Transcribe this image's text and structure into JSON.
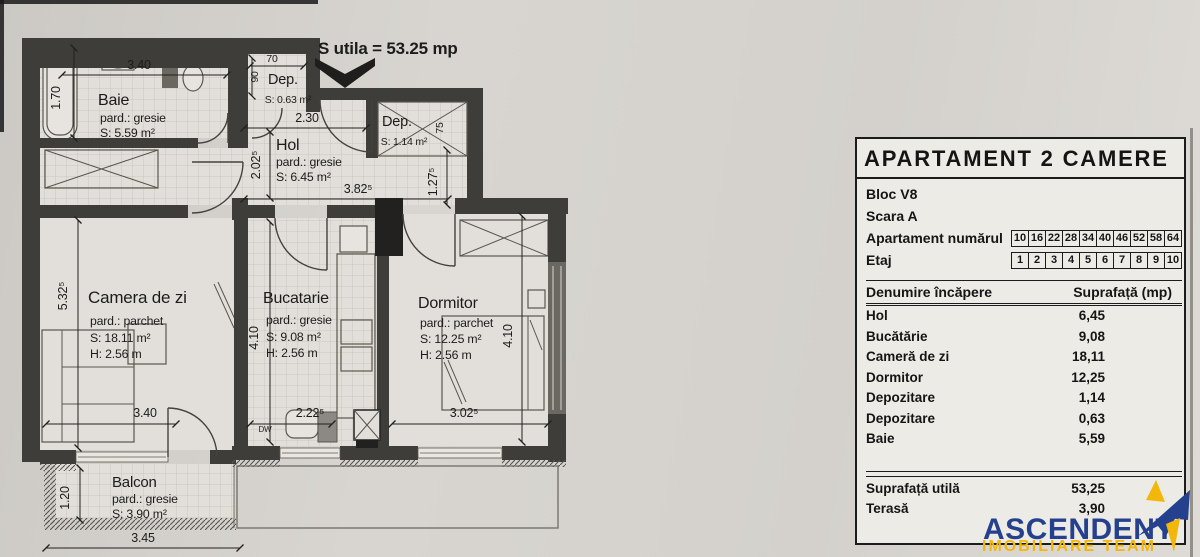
{
  "plan": {
    "utila_note": "S utila = 53.25 mp",
    "rooms": {
      "baie": {
        "name": "Baie",
        "floor": "pard.: gresie",
        "area": "S: 5.59 m²"
      },
      "dep1": {
        "name": "Dep.",
        "area": "S: 0.63 m²"
      },
      "hol": {
        "name": "Hol",
        "floor": "pard.: gresie",
        "area": "S: 6.45 m²"
      },
      "dep2": {
        "name": "Dep.",
        "area": "S: 1.14 m²"
      },
      "camera_de_zi": {
        "name": "Camera de zi",
        "floor": "pard.: parchet",
        "area": "S: 18.11 m²",
        "height": "H: 2.56 m"
      },
      "bucatarie": {
        "name": "Bucatarie",
        "floor": "pard.: gresie",
        "area": "S: 9.08 m²",
        "height": "H: 2.56 m"
      },
      "dormitor": {
        "name": "Dormitor",
        "floor": "pard.: parchet",
        "area": "S: 12.25 m²",
        "height": "H: 2.56 m"
      },
      "balcon": {
        "name": "Balcon",
        "floor": "pard.: gresie",
        "area": "S: 3.90 m²"
      }
    },
    "dims": {
      "baie_w": "3.40",
      "baie_h": "1.70",
      "dep1_w": "70",
      "dep1_h": "90",
      "hol_w": "2.30",
      "hol_h": "2.02⁵",
      "hol_w2": "3.82⁵",
      "dep2_d": "75",
      "dep2_v": "1.27⁵",
      "camera_w": "3.40",
      "camera_h": "5.32⁵",
      "bucatarie_w": "2.22⁵",
      "bucatarie_h": "4.10",
      "dormitor_w": "3.02⁵",
      "dormitor_h": "4.10",
      "balcon_w": "3.45",
      "balcon_h": "1.20",
      "dishwasher": "DW"
    }
  },
  "panel": {
    "title": "APARTAMENT 2 CAMERE",
    "bloc": "Bloc V8",
    "scara": "Scara A",
    "apartament_label": "Apartament numărul",
    "apartament_numbers": [
      "10",
      "16",
      "22",
      "28",
      "34",
      "40",
      "46",
      "52",
      "58",
      "64"
    ],
    "etaj_label": "Etaj",
    "etaj_numbers": [
      "1",
      "2",
      "3",
      "4",
      "5",
      "6",
      "7",
      "8",
      "9",
      "10"
    ],
    "table": {
      "col_room": "Denumire încăpere",
      "col_area": "Suprafață (mp)",
      "rows": [
        {
          "room": "Hol",
          "area": "6,45"
        },
        {
          "room": "Bucătărie",
          "area": "9,08"
        },
        {
          "room": "Cameră de zi",
          "area": "18,11"
        },
        {
          "room": "Dormitor",
          "area": "12,25"
        },
        {
          "room": "Depozitare",
          "area": "1,14"
        },
        {
          "room": "Depozitare",
          "area": "0,63"
        },
        {
          "room": "Baie",
          "area": "5,59"
        }
      ],
      "totals": [
        {
          "room": "Suprafață utilă",
          "area": "53,25"
        },
        {
          "room": "Terasă",
          "area": "3,90"
        }
      ]
    }
  },
  "logo": {
    "name": "ASCENDENT",
    "tagline": "IMOBILIARE TEAM",
    "navy": "#25418e",
    "yellow": "#f3b70a"
  }
}
